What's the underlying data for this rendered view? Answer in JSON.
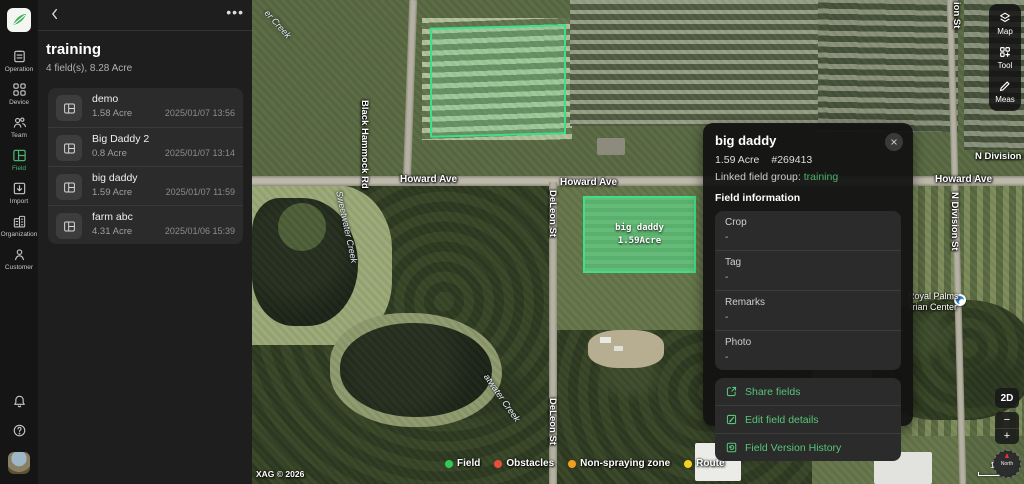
{
  "theme": {
    "accent": "#4db36b"
  },
  "sidebar": {
    "items": [
      {
        "label": "Operation"
      },
      {
        "label": "Device"
      },
      {
        "label": "Team"
      },
      {
        "label": "Field"
      },
      {
        "label": "Import"
      },
      {
        "label": "Organization"
      },
      {
        "label": "Customer"
      }
    ]
  },
  "field_panel": {
    "title": "training",
    "subtitle": "4 field(s), 8.28 Acre",
    "fields": [
      {
        "name": "demo",
        "area": "1.58 Acre",
        "date": "2025/01/07 13:56"
      },
      {
        "name": "Big Daddy 2",
        "area": "0.8 Acre",
        "date": "2025/01/07 13:14"
      },
      {
        "name": "big daddy",
        "area": "1.59 Acre",
        "date": "2025/01/07 11:59"
      },
      {
        "name": "farm abc",
        "area": "4.31 Acre",
        "date": "2025/01/06 15:39"
      }
    ]
  },
  "info_panel": {
    "title": "big daddy",
    "area": "1.59 Acre",
    "field_id": "#269413",
    "linked_label": "Linked field group:",
    "linked_value": "training",
    "section_title": "Field information",
    "rows": [
      {
        "label": "Crop",
        "value": "-"
      },
      {
        "label": "Tag",
        "value": "-"
      },
      {
        "label": "Remarks",
        "value": "-"
      },
      {
        "label": "Photo",
        "value": "-"
      }
    ],
    "actions": [
      {
        "label": "Share fields"
      },
      {
        "label": "Edit field details"
      },
      {
        "label": "Field Version History"
      }
    ]
  },
  "map": {
    "selected_field": {
      "name": "big daddy",
      "area": "1.59Acre"
    },
    "streets": {
      "howard_1": "Howard Ave",
      "howard_2": "Howard Ave",
      "howard_3": "Howard Ave",
      "black_hammock": "Black Hammock Rd",
      "deleon_1": "DeLeon St",
      "deleon_2": "DeLeon St",
      "ndivision_top": "ion St",
      "ndivision_h": "N Division S",
      "ndivision_v": "N Division St",
      "creek_top": "er Creek",
      "creek_mid": "Sweetwater Creek",
      "creek_bottom": "atwater Creek"
    },
    "poi": {
      "line1": "Royal Palms",
      "line2": "itrian Center"
    },
    "legend": [
      {
        "label": "Field",
        "color": "#34c759"
      },
      {
        "label": "Obstacles",
        "color": "#eb4d3d"
      },
      {
        "label": "Non-spraying zone",
        "color": "#f0a01e"
      },
      {
        "label": "Route",
        "color": "#f5d220"
      }
    ],
    "copyright": "XAG © 2026",
    "scale_label": "10 m",
    "controls": {
      "mode": "2D",
      "zoom_out": "−",
      "zoom_in": "+",
      "compass": "North"
    },
    "toolbar": [
      {
        "label": "Map"
      },
      {
        "label": "Tool"
      },
      {
        "label": "Meas"
      }
    ]
  }
}
